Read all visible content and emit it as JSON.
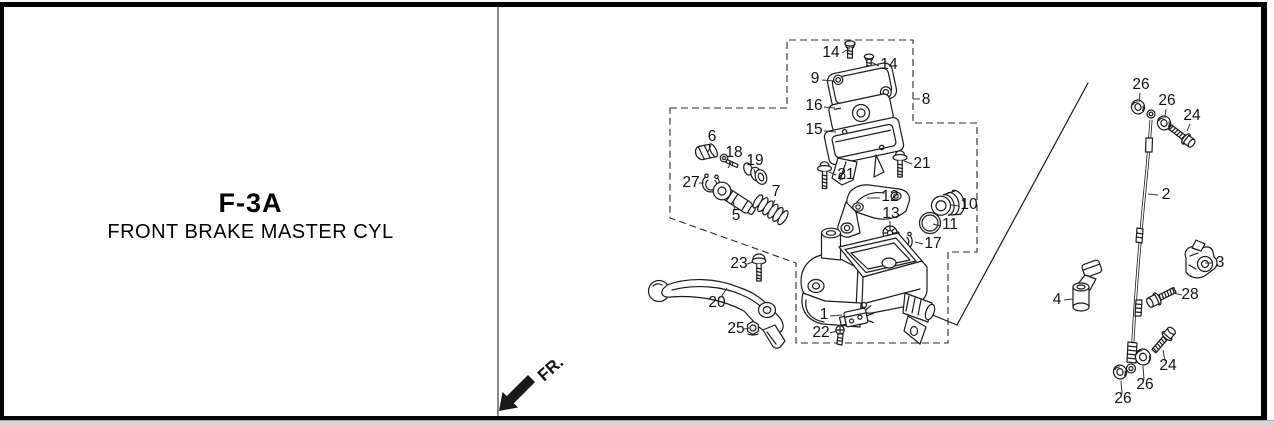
{
  "page": {
    "title": "F-3A",
    "subtitle": "FRONT BRAKE MASTER CYL",
    "fr_label": "FR.",
    "colors": {
      "line": "#1a1a1a",
      "background": "#ffffff",
      "border": "#000000",
      "divider": "#8c8c8c",
      "bottom_bar": "#d6d6d6"
    }
  },
  "diagram": {
    "part_labels": [
      {
        "text": "14",
        "x": 831,
        "y": 57,
        "leader": [
          842,
          53,
          850,
          48
        ]
      },
      {
        "text": "14",
        "x": 889,
        "y": 69,
        "leader": [
          879,
          66,
          871,
          62
        ]
      },
      {
        "text": "9",
        "x": 815,
        "y": 83,
        "leader": [
          822,
          80,
          834,
          81
        ]
      },
      {
        "text": "16",
        "x": 814,
        "y": 110,
        "leader": [
          824,
          107,
          835,
          108
        ]
      },
      {
        "text": "15",
        "x": 814,
        "y": 134,
        "leader": [
          824,
          131,
          836,
          132
        ]
      },
      {
        "text": "8",
        "x": 926,
        "y": 104,
        "leader": [
          920,
          99,
          913,
          99
        ]
      },
      {
        "text": "21",
        "x": 846,
        "y": 179,
        "leader": [
          836,
          175,
          829,
          172
        ]
      },
      {
        "text": "21",
        "x": 922,
        "y": 168,
        "leader": [
          912,
          164,
          904,
          161
        ]
      },
      {
        "text": "12",
        "x": 890,
        "y": 201,
        "leader": [
          880,
          198,
          867,
          198
        ]
      },
      {
        "text": "13",
        "x": 891,
        "y": 218,
        "leader": [
          890,
          221,
          890,
          227
        ]
      },
      {
        "text": "10",
        "x": 969,
        "y": 209,
        "leader": [
          959,
          206,
          951,
          205
        ]
      },
      {
        "text": "11",
        "x": 950,
        "y": 229,
        "leader": [
          941,
          226,
          933,
          224
        ]
      },
      {
        "text": "17",
        "x": 933,
        "y": 248,
        "leader": [
          923,
          244,
          915,
          242
        ]
      },
      {
        "text": "1",
        "x": 824,
        "y": 319,
        "leader": [
          830,
          316,
          842,
          315
        ]
      },
      {
        "text": "22",
        "x": 821,
        "y": 337,
        "leader": [
          830,
          333,
          837,
          331
        ]
      },
      {
        "text": "23",
        "x": 739,
        "y": 268,
        "leader": [
          747,
          264,
          753,
          262
        ]
      },
      {
        "text": "20",
        "x": 717,
        "y": 307,
        "leader": [
          721,
          297,
          727,
          288
        ]
      },
      {
        "text": "25",
        "x": 736,
        "y": 333,
        "leader": [
          744,
          329,
          749,
          328
        ]
      },
      {
        "text": "6",
        "x": 712,
        "y": 141,
        "leader": [
          711,
          145,
          708,
          152
        ]
      },
      {
        "text": "18",
        "x": 734,
        "y": 157,
        "leader": [
          732,
          161,
          728,
          168
        ]
      },
      {
        "text": "19",
        "x": 755,
        "y": 165,
        "leader": [
          754,
          169,
          755,
          174
        ]
      },
      {
        "text": "27",
        "x": 691,
        "y": 187,
        "leader": [
          699,
          183,
          704,
          183
        ]
      },
      {
        "text": "5",
        "x": 736,
        "y": 220,
        "leader": [
          735,
          210,
          733,
          201
        ]
      },
      {
        "text": "7",
        "x": 776,
        "y": 196,
        "leader": [
          775,
          200,
          772,
          207
        ]
      },
      {
        "text": "2",
        "x": 1166,
        "y": 199,
        "leader": [
          1158,
          195,
          1148,
          194
        ]
      },
      {
        "text": "26",
        "x": 1141,
        "y": 89,
        "leader": [
          1140,
          93,
          1139,
          102
        ]
      },
      {
        "text": "26",
        "x": 1167,
        "y": 105,
        "leader": [
          1166,
          109,
          1165,
          118
        ]
      },
      {
        "text": "24",
        "x": 1192,
        "y": 120,
        "leader": [
          1190,
          124,
          1187,
          131
        ]
      },
      {
        "text": "3",
        "x": 1220,
        "y": 267,
        "leader": [
          1213,
          263,
          1205,
          263
        ]
      },
      {
        "text": "4",
        "x": 1057,
        "y": 304,
        "leader": [
          1064,
          300,
          1073,
          299
        ]
      },
      {
        "text": "28",
        "x": 1190,
        "y": 299,
        "leader": [
          1182,
          295,
          1173,
          293
        ]
      },
      {
        "text": "24",
        "x": 1168,
        "y": 370,
        "leader": [
          1165,
          361,
          1163,
          350
        ]
      },
      {
        "text": "26",
        "x": 1145,
        "y": 389,
        "leader": [
          1144,
          380,
          1143,
          366
        ]
      },
      {
        "text": "26",
        "x": 1123,
        "y": 403,
        "leader": [
          1122,
          394,
          1121,
          381
        ]
      }
    ],
    "boundary_points": "670,108 787,108 787,40 913,40 913,123 977,123 977,252 948,252 948,343 796,343 796,263 670,218",
    "connector_lines": [
      [
        896,
        300,
        957,
        325
      ],
      [
        957,
        325,
        1088,
        83
      ]
    ]
  }
}
